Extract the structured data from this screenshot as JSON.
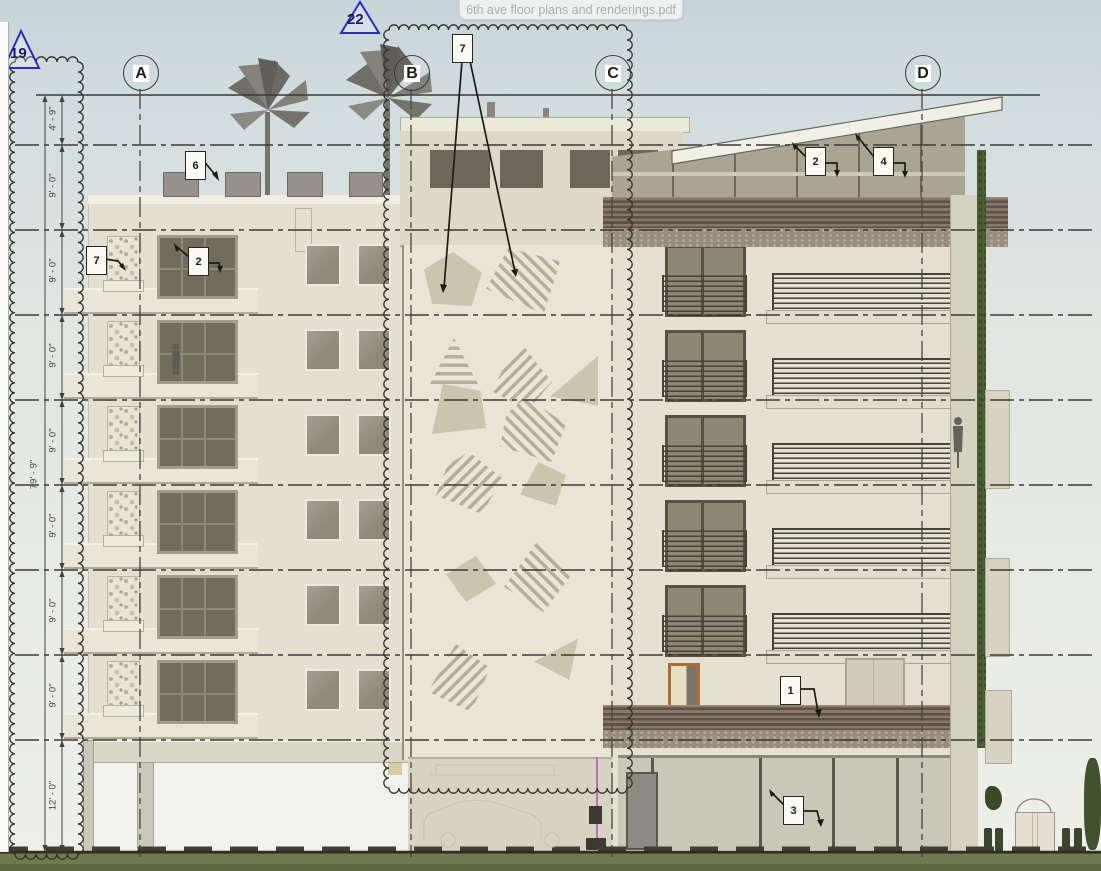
{
  "viewer": {
    "tooltip_filename": "6th ave floor plans and renderings.pdf"
  },
  "sheet": {
    "grid_bubbles": [
      {
        "label": "A"
      },
      {
        "label": "B"
      },
      {
        "label": "C"
      },
      {
        "label": "D"
      }
    ],
    "section_markers": [
      {
        "label": "19"
      },
      {
        "label": "22"
      }
    ],
    "callouts": {
      "roof_parapet": "6",
      "stone_panel": "7",
      "left_window": "2",
      "mural": "7",
      "penthouse_left": "2",
      "penthouse_right": "4",
      "wood_screen": "1",
      "storefront": "3"
    },
    "dimensions": {
      "overall": "79' - 9\"",
      "floors": [
        "4' - 9\"",
        "9' - 0\"",
        "9' - 0\"",
        "9' - 0\"",
        "9' - 0\"",
        "9' - 0\"",
        "9' - 0\"",
        "9' - 0\"",
        "12' - 0\""
      ]
    },
    "colors": {
      "sky": "#ccd9db",
      "facade": "#e3e0d1",
      "penthouse": "#a9a593",
      "wood_screen": "#6f6257",
      "grass": "#6b7850",
      "marker_blue": "#2a2ac8",
      "mural_stripe": "#b7af97"
    }
  }
}
